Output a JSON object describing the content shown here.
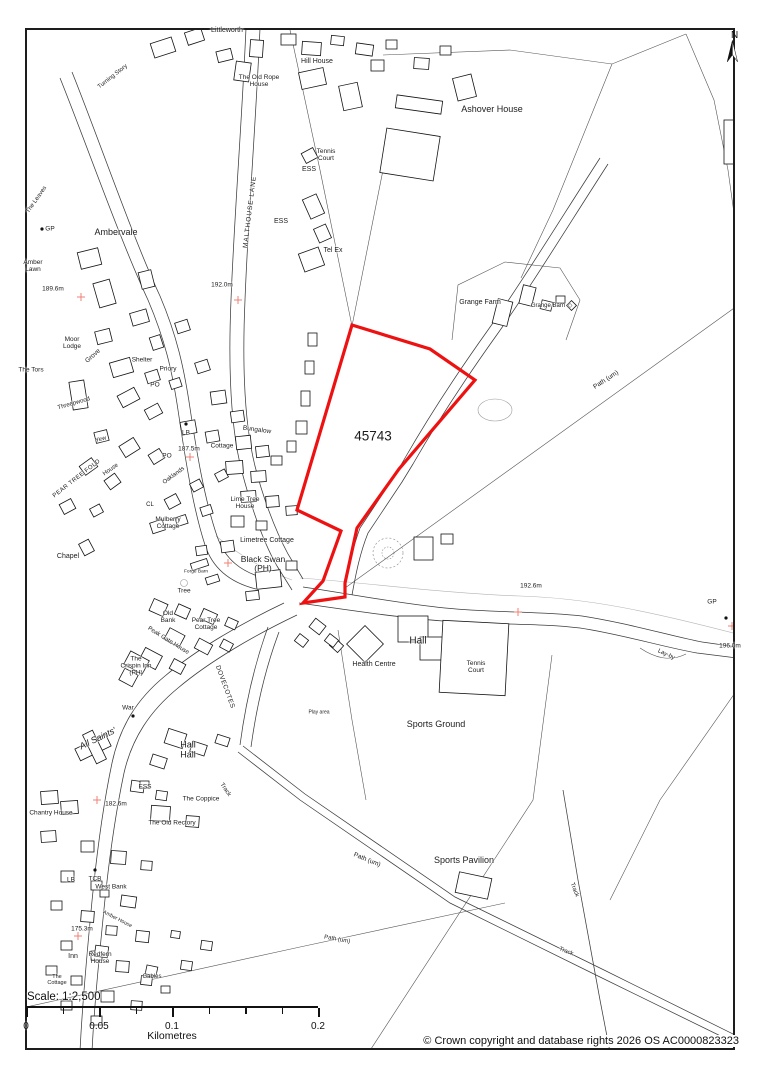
{
  "map": {
    "region_label": "45743",
    "scale_text": "Scale: 1:2,500",
    "north_label": "N",
    "copyright": "© Crown copyright and database rights 2026 OS AC0000823323",
    "colors": {
      "boundary": "#ee1111",
      "grid_cross": "#ef8276",
      "frame": "#1d1d1d"
    },
    "boundary": {
      "label": "45743",
      "points": [
        [
          352,
          325
        ],
        [
          430,
          349
        ],
        [
          475,
          380
        ],
        [
          399,
          469
        ],
        [
          394,
          476
        ],
        [
          357,
          528
        ],
        [
          345,
          583
        ],
        [
          345,
          597
        ],
        [
          303,
          603
        ],
        [
          323,
          581
        ],
        [
          341,
          531
        ],
        [
          297,
          510
        ]
      ]
    },
    "grid_crosses": [
      [
        81,
        297
      ],
      [
        238,
        300
      ],
      [
        190,
        457
      ],
      [
        228,
        563
      ],
      [
        518,
        612
      ],
      [
        732,
        626
      ],
      [
        97,
        800
      ],
      [
        78,
        936
      ]
    ],
    "scalebar": {
      "unit": "Kilometres",
      "ticks": [
        {
          "frac": 0,
          "label": "0"
        },
        {
          "frac": 0.125,
          "label": ""
        },
        {
          "frac": 0.25,
          "label": "0.05"
        },
        {
          "frac": 0.375,
          "label": ""
        },
        {
          "frac": 0.5,
          "label": "0.1"
        },
        {
          "frac": 0.625,
          "label": ""
        },
        {
          "frac": 0.75,
          "label": ""
        },
        {
          "frac": 0.875,
          "label": ""
        },
        {
          "frac": 1,
          "label": "0.2"
        }
      ]
    },
    "labels": [
      {
        "text": "Littleworth",
        "x": 227,
        "y": 31,
        "size": 7
      },
      {
        "text": "Hill House",
        "x": 317,
        "y": 62,
        "size": 7
      },
      {
        "text": "The Old Rope\nHouse",
        "x": 259,
        "y": 81,
        "size": 6.5
      },
      {
        "text": "Ashover House",
        "x": 492,
        "y": 110,
        "size": 9
      },
      {
        "text": "Tennis\nCourt",
        "x": 326,
        "y": 155,
        "size": 6.5
      },
      {
        "text": "ESS",
        "x": 309,
        "y": 170,
        "size": 7
      },
      {
        "text": "ESS",
        "x": 281,
        "y": 222,
        "size": 7
      },
      {
        "text": "Tel Ex",
        "x": 333,
        "y": 251,
        "size": 7
      },
      {
        "text": "MALTHOUSE LANE",
        "x": 250,
        "y": 212,
        "size": 6.5,
        "rot": -83,
        "ls": 1
      },
      {
        "text": "Ambervale",
        "x": 116,
        "y": 233,
        "size": 9
      },
      {
        "text": "Amber\nLawn",
        "x": 33,
        "y": 266,
        "size": 6.5
      },
      {
        "text": "189.6m",
        "x": 53,
        "y": 289,
        "size": 6.5
      },
      {
        "text": "GP",
        "x": 50,
        "y": 229,
        "size": 6.5
      },
      {
        "text": "192.0m",
        "x": 222,
        "y": 285,
        "size": 6.5
      },
      {
        "text": "Moor\nLodge",
        "x": 72,
        "y": 343,
        "size": 6.5
      },
      {
        "text": "The Tors",
        "x": 31,
        "y": 370,
        "size": 6.5
      },
      {
        "text": "Grove",
        "x": 93,
        "y": 356,
        "size": 6.5,
        "rot": -42
      },
      {
        "text": "Shelter",
        "x": 142,
        "y": 360,
        "size": 6.5
      },
      {
        "text": "Priory",
        "x": 168,
        "y": 369,
        "size": 6.5
      },
      {
        "text": "PO",
        "x": 155,
        "y": 385,
        "size": 6.5
      },
      {
        "text": "The Leaves",
        "x": 37,
        "y": 200,
        "size": 6,
        "rot": -55
      },
      {
        "text": "Turning Story",
        "x": 113,
        "y": 77,
        "size": 6,
        "rot": -38
      },
      {
        "text": "Grange Farm",
        "x": 480,
        "y": 303,
        "size": 7
      },
      {
        "text": "Grange Barn",
        "x": 548,
        "y": 306,
        "size": 6
      },
      {
        "text": "◇",
        "x": 570,
        "y": 306,
        "size": 6
      },
      {
        "text": "Path (um)",
        "x": 606,
        "y": 380,
        "size": 6.5,
        "rot": -33
      },
      {
        "text": "45743",
        "x": 373,
        "y": 437,
        "size": 13.5
      },
      {
        "text": "Threepwood",
        "x": 74,
        "y": 404,
        "size": 6,
        "rot": -16
      },
      {
        "text": "Yew",
        "x": 101,
        "y": 440,
        "size": 6,
        "rot": -15
      },
      {
        "text": "LB",
        "x": 186,
        "y": 433,
        "size": 6.5
      },
      {
        "text": "187.5m",
        "x": 189,
        "y": 449,
        "size": 6.5
      },
      {
        "text": "Cottage",
        "x": 222,
        "y": 446,
        "size": 6.5
      },
      {
        "text": "Bungalow",
        "x": 257,
        "y": 430,
        "size": 6.5,
        "rot": 8
      },
      {
        "text": "PEAR TREE FOLD",
        "x": 77,
        "y": 479,
        "size": 6,
        "rot": -38,
        "ls": 0.5
      },
      {
        "text": "House",
        "x": 111,
        "y": 470,
        "size": 6,
        "rot": -35
      },
      {
        "text": "PO",
        "x": 167,
        "y": 456,
        "size": 6.5
      },
      {
        "text": "Oaklands",
        "x": 174,
        "y": 476,
        "size": 6,
        "rot": -36
      },
      {
        "text": "CL",
        "x": 150,
        "y": 505,
        "size": 6
      },
      {
        "text": "Mulberry\nCottage",
        "x": 168,
        "y": 523,
        "size": 6.5
      },
      {
        "text": "Lime Tree\nHouse",
        "x": 245,
        "y": 503,
        "size": 6.5
      },
      {
        "text": "Chapel",
        "x": 68,
        "y": 557,
        "size": 7
      },
      {
        "text": "Forge Barn",
        "x": 196,
        "y": 572,
        "size": 4.8
      },
      {
        "text": "Tree",
        "x": 184,
        "y": 591,
        "size": 6.5
      },
      {
        "text": "Limetree Cottage",
        "x": 267,
        "y": 541,
        "size": 7
      },
      {
        "text": "Black Swan\n(PH)",
        "x": 263,
        "y": 564,
        "size": 8.5
      },
      {
        "text": "Old\nBank",
        "x": 168,
        "y": 617,
        "size": 6.5
      },
      {
        "text": "Pear Tree\nCottage",
        "x": 206,
        "y": 624,
        "size": 6.5
      },
      {
        "text": "Peak Gate House",
        "x": 168,
        "y": 641,
        "size": 6,
        "rot": 32
      },
      {
        "text": "The\nCrispin Inn\n(PH)",
        "x": 136,
        "y": 666,
        "size": 6.5
      },
      {
        "text": "War",
        "x": 128,
        "y": 708,
        "size": 6.5
      },
      {
        "text": "All Saints'",
        "x": 98,
        "y": 739,
        "size": 9,
        "rot": -26,
        "italic": true
      },
      {
        "text": "Hall\nHall",
        "x": 188,
        "y": 750,
        "size": 9
      },
      {
        "text": "DOVECOTES",
        "x": 225,
        "y": 687,
        "size": 6.5,
        "rot": 70,
        "ls": 0.5
      },
      {
        "text": "ESS",
        "x": 145,
        "y": 787,
        "size": 6.5
      },
      {
        "text": "The Coppice",
        "x": 201,
        "y": 799,
        "size": 6.5
      },
      {
        "text": "182.6m",
        "x": 116,
        "y": 804,
        "size": 6.5
      },
      {
        "text": "Chantry House",
        "x": 51,
        "y": 813,
        "size": 6.5
      },
      {
        "text": "The Old Rectory",
        "x": 172,
        "y": 823,
        "size": 6.5
      },
      {
        "text": "Track",
        "x": 225,
        "y": 790,
        "size": 6,
        "rot": 55
      },
      {
        "text": "LB",
        "x": 71,
        "y": 880,
        "size": 6.5
      },
      {
        "text": "TCB",
        "x": 95,
        "y": 879,
        "size": 6.5
      },
      {
        "text": "West Bank",
        "x": 111,
        "y": 887,
        "size": 6.5
      },
      {
        "text": "Amber House",
        "x": 117,
        "y": 920,
        "size": 5.2,
        "rot": 27
      },
      {
        "text": "175.3m",
        "x": 82,
        "y": 929,
        "size": 6.5
      },
      {
        "text": "Inn",
        "x": 73,
        "y": 957,
        "size": 7
      },
      {
        "text": "Redfern\nHouse",
        "x": 100,
        "y": 958,
        "size": 6.5
      },
      {
        "text": "The\nCottage",
        "x": 57,
        "y": 981,
        "size": 5.5
      },
      {
        "text": "Gables",
        "x": 152,
        "y": 977,
        "size": 6
      },
      {
        "text": "Hall",
        "x": 418,
        "y": 642,
        "size": 10
      },
      {
        "text": "Health Centre",
        "x": 374,
        "y": 665,
        "size": 7
      },
      {
        "text": "Tennis\nCourt",
        "x": 476,
        "y": 667,
        "size": 6.5
      },
      {
        "text": "Play area",
        "x": 319,
        "y": 713,
        "size": 5
      },
      {
        "text": "Sports Ground",
        "x": 436,
        "y": 725,
        "size": 9
      },
      {
        "text": "192.6m",
        "x": 531,
        "y": 586,
        "size": 6.5
      },
      {
        "text": "GP",
        "x": 712,
        "y": 602,
        "size": 6.5
      },
      {
        "text": "196.0m",
        "x": 730,
        "y": 646,
        "size": 6.5
      },
      {
        "text": "Lay-by",
        "x": 666,
        "y": 655,
        "size": 6,
        "rot": 25
      },
      {
        "text": "Path (um)",
        "x": 367,
        "y": 860,
        "size": 6.5,
        "rot": 22
      },
      {
        "text": "Sports Pavilion",
        "x": 464,
        "y": 861,
        "size": 9
      },
      {
        "text": "Path (um)",
        "x": 337,
        "y": 940,
        "size": 6,
        "rot": 10
      },
      {
        "text": "Track",
        "x": 574,
        "y": 890,
        "size": 6,
        "rot": 68
      },
      {
        "text": "Track",
        "x": 566,
        "y": 952,
        "size": 6,
        "rot": 22
      }
    ]
  }
}
